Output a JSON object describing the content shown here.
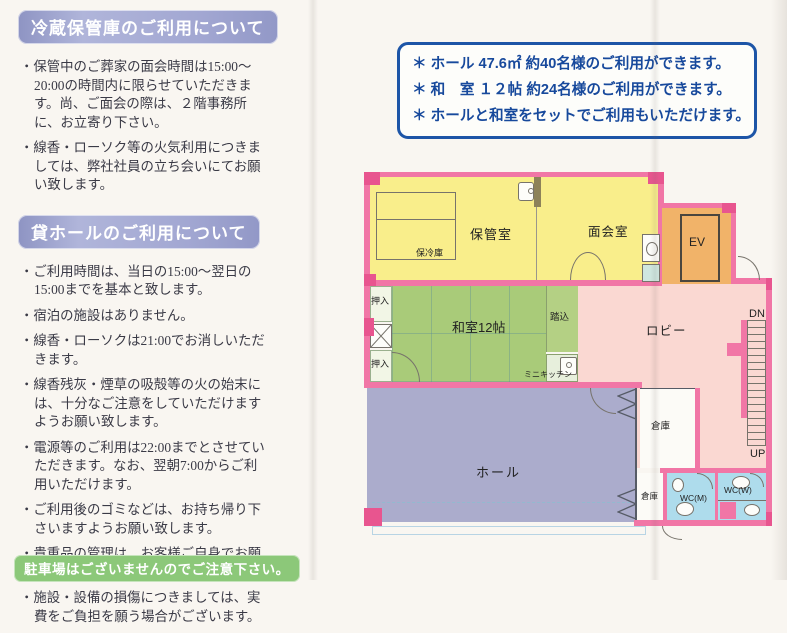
{
  "page": {
    "background": "#f9f6f1"
  },
  "left_column": {
    "sections": [
      {
        "title": "冷蔵保管庫のご利用について",
        "items": [
          "・保管中のご葬家の面会時間は15:00～20:00の時間内に限らせていただきます。尚、ご面会の際は、２階事務所に、お立寄り下さい。",
          "・線香・ローソク等の火気利用につきましては、弊社社員の立ち会いにてお願い致します。"
        ]
      },
      {
        "title": "貸ホールのご利用について",
        "items": [
          "・ご利用時間は、当日の15:00～翌日の15:00までを基本と致します。",
          "・宿泊の施設はありません。",
          "・線香・ローソクは21:00でお消しいただきます。",
          "・線香残灰・煙草の吸殻等の火の始末には、十分なご注意をしていただけますようお願い致します。",
          "・電源等のご利用は22:00までとさせていただきます。なお、翌朝7:00からご利用いただけます。",
          "・ご利用後のゴミなどは、お持ち帰り下さいますようお願い致します。",
          "・貴重品の管理は、お客様ご自身でお願い致します。",
          "・施設・設備の損傷につきましては、実費をご負担を願う場合がございます。"
        ]
      }
    ],
    "footer_note": "駐車場はございませんのでご注意下さい。"
  },
  "info_box": {
    "lines": [
      "＊ ホール 47.6㎡ 約40名様のご利用ができます。",
      "＊ 和　室 １２帖 約24名様のご利用ができます。",
      "＊ ホールと和室をセットでご利用もいただけます。"
    ],
    "border_color": "#1d55a7",
    "text_color": "#17499c"
  },
  "floor_plan": {
    "labels": {
      "storage_room": "保管室",
      "cold_storage": "保冷庫",
      "meeting_room": "面会室",
      "elevator": "EV",
      "closet_top": "押入",
      "closet_bottom": "押入",
      "japanese_room": "和室12帖",
      "fumikomi": "踏込",
      "mini_kitchen": "ミニキッチン",
      "lobby": "ロビー",
      "stairs_down": "DN",
      "stairs_up": "UP",
      "hall": "ホール",
      "storage_large": "倉庫",
      "storage_small": "倉庫",
      "wc_men": "WC(M)",
      "wc_women": "WC(W)"
    },
    "colors": {
      "wall": "#f176a6",
      "wall_dark": "#e8558f",
      "yellow_room": "#f9ee8b",
      "tatami": "#a9cb79",
      "lobby": "#fad8d2",
      "hall": "#abaccc",
      "elevator": "#f1b369",
      "wc": "#aedcec",
      "storage": "#fcfbf7",
      "green_bar": "#8cc879",
      "header_chip": "#a2a7d2"
    }
  }
}
